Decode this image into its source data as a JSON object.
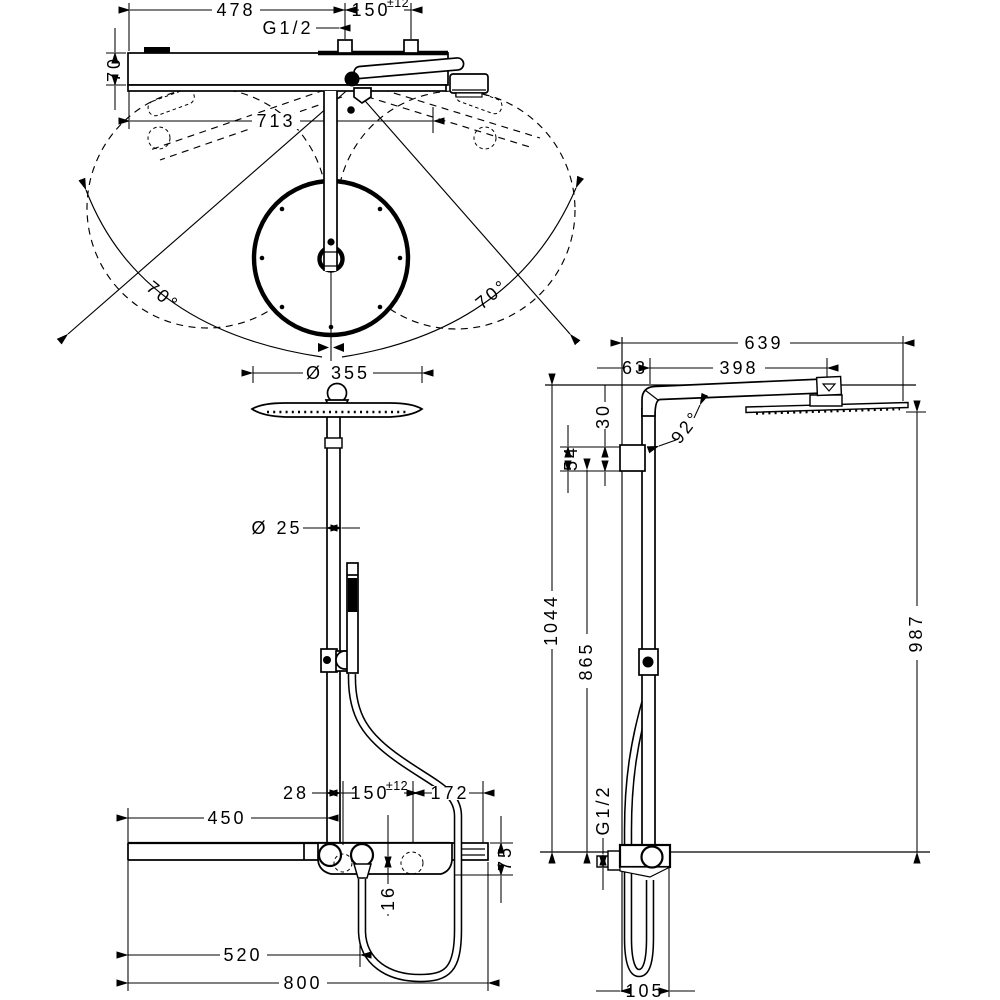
{
  "top_view": {
    "dim_478": "478",
    "dim_150": "150",
    "dim_150_tol": "±12",
    "thread_label": "G1/2",
    "dim_70": "70",
    "dim_713": "713",
    "swivel_left": "70°",
    "swivel_right": "70°"
  },
  "front_view": {
    "dim_head_diameter": "Ø 355",
    "dim_pipe_diameter": "Ø 25",
    "dim_28": "28",
    "dim_150": "150",
    "dim_150_tol": "±12",
    "dim_172": "172",
    "dim_450": "450",
    "dim_75": "75",
    "dim_16": "16",
    "dim_520": "520",
    "dim_800": "800"
  },
  "side_view": {
    "dim_639": "639",
    "dim_63": "63",
    "dim_398": "398",
    "dim_30": "30",
    "dim_54": "54",
    "angle_92": "92°",
    "dim_1044": "1044",
    "dim_865": "865",
    "dim_987": "987",
    "thread_label": "G1/2",
    "dim_105": "105"
  }
}
